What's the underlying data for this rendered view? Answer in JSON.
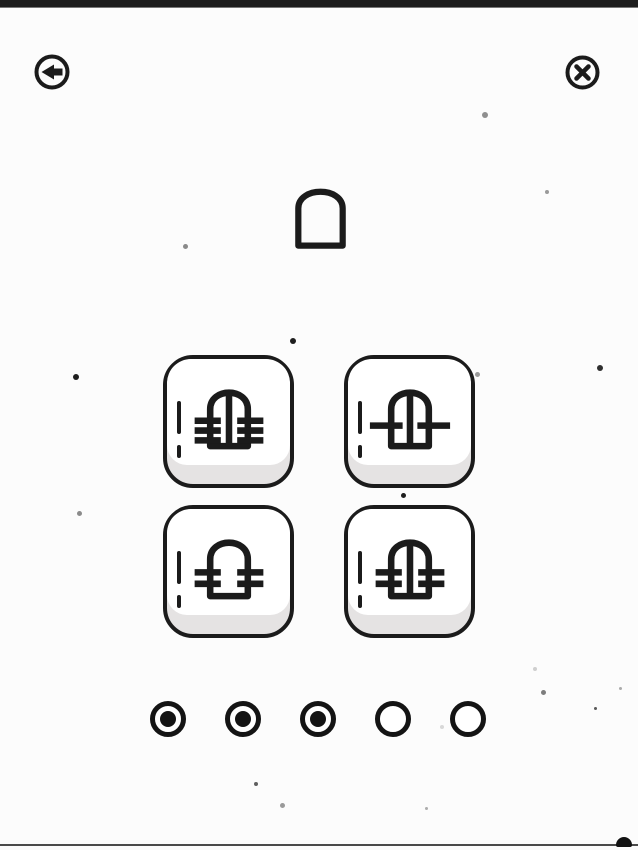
{
  "screen": {
    "type": "puzzle-level",
    "width": 638,
    "height": 850
  },
  "colors": {
    "ink": "#1b1b1b",
    "background": "#fcfcfc",
    "tile_face": "#ffffff",
    "tile_shadow": "#e5e3e3",
    "letterbox_bar": "#1d1d1d",
    "bottom_line": "#4a4a4a"
  },
  "header": {
    "back_label": "Back",
    "close_label": "Close"
  },
  "target": {
    "shape": "arch-outline",
    "label": "Target shape: plain arch"
  },
  "options": [
    {
      "id": 1,
      "position": "top-left",
      "shape": "arch",
      "center_line": true,
      "side_ticks": 3,
      "label": "Arch with center line and 3 side ticks"
    },
    {
      "id": 2,
      "position": "top-right",
      "shape": "arch",
      "center_line": true,
      "side_ticks": 1,
      "label": "Arch with center line and 1 side tick"
    },
    {
      "id": 3,
      "position": "bottom-left",
      "shape": "arch",
      "center_line": false,
      "side_ticks": 2,
      "label": "Arch with 2 side ticks, no center line"
    },
    {
      "id": 4,
      "position": "bottom-right",
      "shape": "arch",
      "center_line": true,
      "side_ticks": 2,
      "label": "Arch with center line and 2 side ticks"
    }
  ],
  "progress": {
    "total": 5,
    "filled": 3,
    "dots": [
      "filled",
      "filled",
      "filled",
      "empty",
      "empty"
    ]
  },
  "decor": {
    "specks": [
      {
        "x": 485,
        "y": 115,
        "d": 6,
        "c": "#8f8f8f"
      },
      {
        "x": 547,
        "y": 192,
        "d": 4,
        "c": "#9a9a9a"
      },
      {
        "x": 185,
        "y": 246,
        "d": 5,
        "c": "#8a8a8a"
      },
      {
        "x": 293,
        "y": 341,
        "d": 6,
        "c": "#1e1e1e"
      },
      {
        "x": 600,
        "y": 368,
        "d": 6,
        "c": "#2f2f2f"
      },
      {
        "x": 76,
        "y": 377,
        "d": 6,
        "c": "#1e1e1e"
      },
      {
        "x": 477,
        "y": 374,
        "d": 5,
        "c": "#9a9a9a"
      },
      {
        "x": 79,
        "y": 513,
        "d": 5,
        "c": "#8b8b8b"
      },
      {
        "x": 403,
        "y": 495,
        "d": 5,
        "c": "#1e1e1e"
      },
      {
        "x": 535,
        "y": 669,
        "d": 4,
        "c": "#cfcfcf"
      },
      {
        "x": 543,
        "y": 692,
        "d": 5,
        "c": "#7d7d7d"
      },
      {
        "x": 620,
        "y": 688,
        "d": 3,
        "c": "#ababab"
      },
      {
        "x": 595,
        "y": 708,
        "d": 3,
        "c": "#5a5a5a"
      },
      {
        "x": 442,
        "y": 727,
        "d": 4,
        "c": "#d8d8d8"
      },
      {
        "x": 256,
        "y": 784,
        "d": 4,
        "c": "#5f5f5f"
      },
      {
        "x": 282,
        "y": 805,
        "d": 5,
        "c": "#9a9a9a"
      },
      {
        "x": 426,
        "y": 808,
        "d": 3,
        "c": "#adadad"
      }
    ]
  }
}
